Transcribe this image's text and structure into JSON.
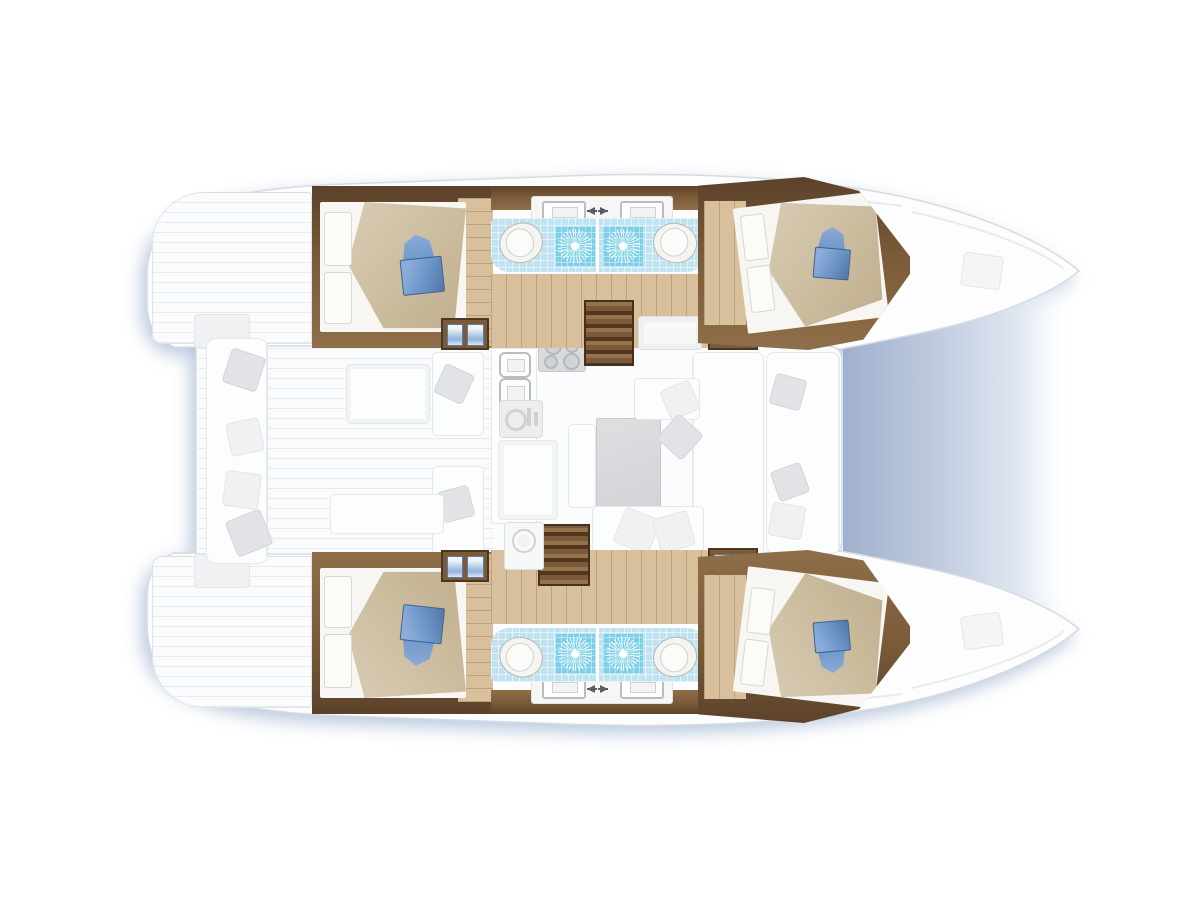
{
  "canvas": {
    "width": 1200,
    "height": 900,
    "background": "#ffffff"
  },
  "figure": {
    "type": "floor-plan",
    "subject": "catamaran yacht interior, top-down view",
    "orientation": "bows to the right",
    "hulls": 2,
    "render_style": "hull interiors in full color, main-deck furniture ghosted gray"
  },
  "palette": {
    "hull_white": "#fdfdfe",
    "hull_outline": "#d6dbe3",
    "water_shadow": "#aebfd8",
    "bow_gap_shade": "#9fb0cc",
    "wood_wall_dark": "#5c422a",
    "wood_wall_mid": "#8a6a45",
    "wood_floor": "#d9c09d",
    "bed_blanket_tan": "#cbbc9e",
    "bed_sheet_white": "#f7f6f2",
    "pillow_blue": "#6f97c9",
    "pillow_blue_dark": "#3c5f90",
    "tile_light_blue": "#c0e3f1",
    "tile_shower_blue": "#7ed0e7",
    "fixture_white": "#f4f4f1",
    "ghost_furniture": "#fbfcfd",
    "ghost_pillow": "#e1e3e7"
  },
  "accommodation": {
    "cabins": [
      {
        "name": "aft port cabin",
        "berth": "double",
        "pillow_accent": "blue"
      },
      {
        "name": "forward port cabin",
        "berth": "double",
        "pillow_accent": "blue"
      },
      {
        "name": "aft starboard cabin",
        "berth": "double",
        "pillow_accent": "blue"
      },
      {
        "name": "forward starboard cabin",
        "berth": "double",
        "pillow_accent": "blue"
      }
    ],
    "heads": 4,
    "toilets": 4,
    "showers_with_sunburst_drain": 4,
    "washbasins": 4,
    "hanging_lockers": 4,
    "staircases_to_hulls": 2
  },
  "main_deck": {
    "galley": {
      "stove_burners": 4,
      "sinks": 2,
      "appliance_icons": [
        "oven-grill-icon"
      ]
    },
    "saloon": {
      "dining_table": 1,
      "sofa": "U-shaped settee",
      "scatter_pillows": true
    },
    "cockpit": {
      "aft_bench": true,
      "table": 1,
      "side_seats": 2,
      "pillows": true
    },
    "foredeck_hatches": 2
  },
  "icons": [
    "sunburst-drain-icon",
    "toilet-icon",
    "washbasin-icon",
    "faucet-arrow-icon",
    "burner-icon",
    "hanging-clothes-icon",
    "washer-drum-icon",
    "deck-hatch-icon"
  ]
}
